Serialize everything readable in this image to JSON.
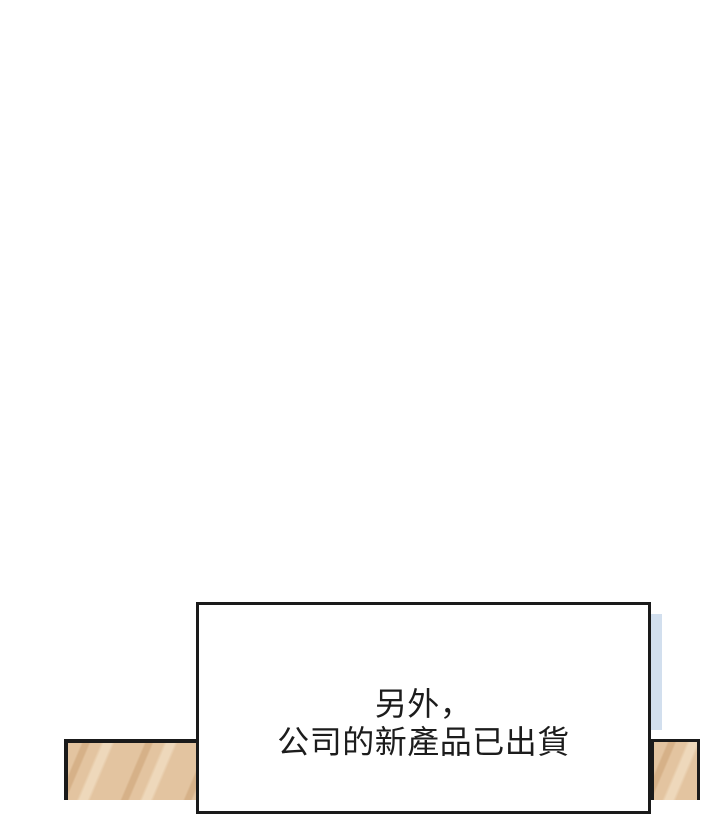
{
  "speech_box": {
    "lines": [
      "另外，",
      "公司的新產品已出貨"
    ]
  },
  "colors": {
    "background": "#ffffff",
    "ink": "#1a1a1a",
    "text": "#1c1c1c",
    "wood_base": "#e3c4a0",
    "wood_light": "#eed8bb",
    "wood_dark": "#d6b188",
    "blue_strip": "#d2dfee"
  }
}
